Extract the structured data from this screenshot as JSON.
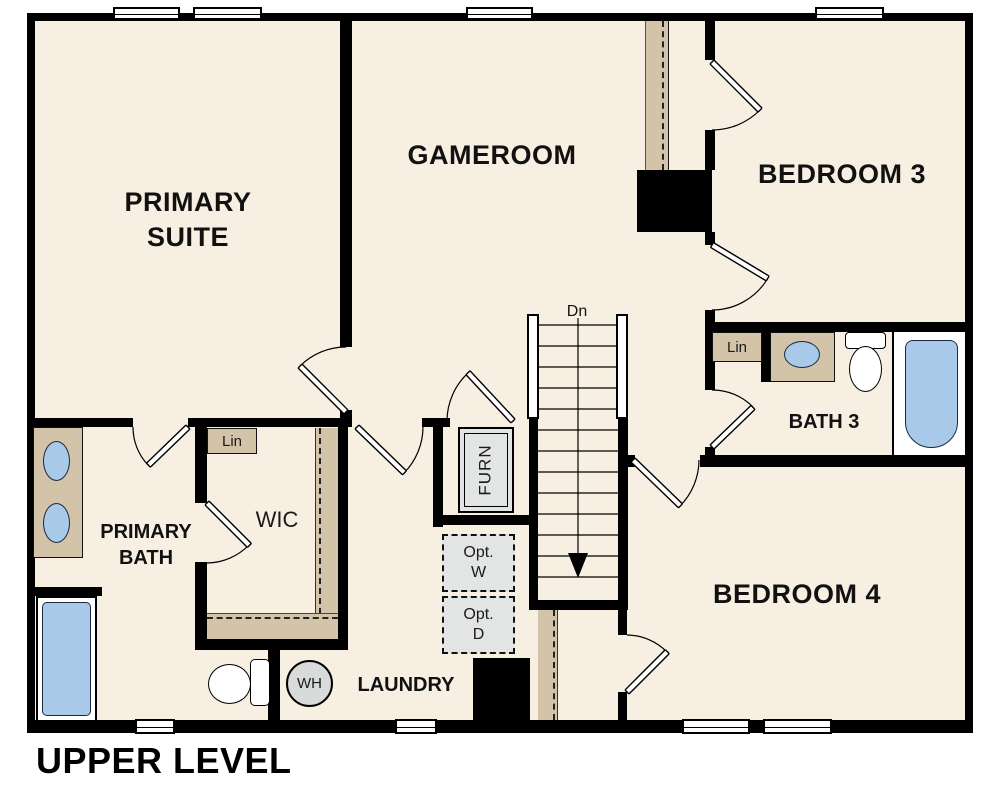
{
  "title": "UPPER LEVEL",
  "rooms": {
    "primary_suite": {
      "line1": "PRIMARY",
      "line2": "SUITE"
    },
    "gameroom": "GAMEROOM",
    "bedroom3": "BEDROOM 3",
    "bedroom4": "BEDROOM 4",
    "bath3": "BATH 3",
    "primary_bath": {
      "line1": "PRIMARY",
      "line2": "BATH"
    },
    "wic": "WIC",
    "laundry": "LAUNDRY"
  },
  "annotations": {
    "stairs_direction": "Dn",
    "linen_closet_wic": "Lin",
    "linen_closet_bath3": "Lin",
    "furnace": "FURN",
    "optional_washer": {
      "line1": "Opt.",
      "line2": "W"
    },
    "optional_dryer": {
      "line1": "Opt.",
      "line2": "D"
    },
    "water_heater": "WH"
  },
  "colors": {
    "wall": "#000000",
    "floor": "#f7efe2",
    "casework": "#d3c4a9",
    "fixture_fill": "#a9c9e9",
    "fixture_border": "#1c2940",
    "appliance_fill": "#e2e5e3",
    "water_heater_fill": "#d8dbd9",
    "text": "#111111"
  }
}
